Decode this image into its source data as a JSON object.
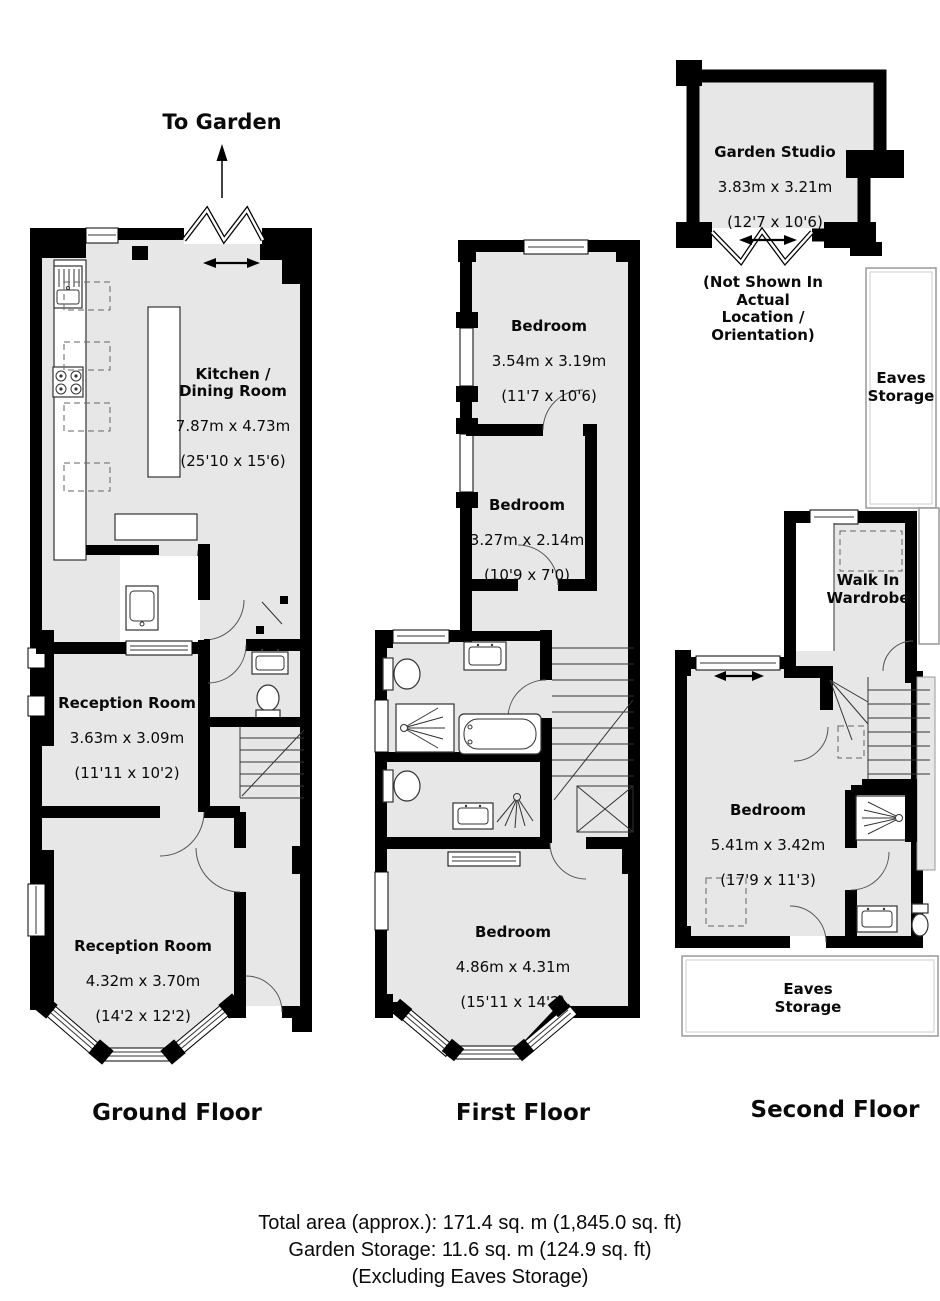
{
  "ground_floor": {
    "title": "Ground Floor",
    "to_garden": "To Garden",
    "kitchen": {
      "name": "Kitchen /\nDining Room",
      "metric": "7.87m x 4.73m",
      "imperial": "(25'10 x 15'6)"
    },
    "reception_1": {
      "name": "Reception Room",
      "metric": "3.63m x 3.09m",
      "imperial": "(11'11 x 10'2)"
    },
    "reception_2": {
      "name": "Reception Room",
      "metric": "4.32m x 3.70m",
      "imperial": "(14'2 x 12'2)"
    }
  },
  "first_floor": {
    "title": "First Floor",
    "bedroom_1": {
      "name": "Bedroom",
      "metric": "3.54m x 3.19m",
      "imperial": "(11'7 x 10'6)"
    },
    "bedroom_2": {
      "name": "Bedroom",
      "metric": "3.27m x 2.14m",
      "imperial": "(10'9 x 7'0)"
    },
    "bedroom_3": {
      "name": "Bedroom",
      "metric": "4.86m x 4.31m",
      "imperial": "(15'11 x 14'2)"
    }
  },
  "second_floor": {
    "title": "Second Floor",
    "garden_studio": {
      "name": "Garden Studio",
      "metric": "3.83m x 3.21m",
      "imperial": "(12'7 x 10'6)",
      "note": "(Not Shown In Actual\nLocation / Orientation)"
    },
    "eaves_storage_top": "Eaves\nStorage",
    "walk_in_wardrobe": "Walk In\nWardrobe",
    "bedroom": {
      "name": "Bedroom",
      "metric": "5.41m x 3.42m",
      "imperial": "(17'9 x 11'3)"
    },
    "eaves_storage_bottom": "Eaves\nStorage"
  },
  "footer": {
    "total_area": "Total area (approx.): 171.4 sq. m (1,845.0 sq. ft)",
    "garden_storage": "Garden Storage: 11.6 sq. m (124.9 sq. ft)",
    "exclusion": "(Excluding Eaves Storage)"
  },
  "colors": {
    "floor_fill": "#e7e7e7",
    "wall": "#000000",
    "background": "#ffffff"
  }
}
